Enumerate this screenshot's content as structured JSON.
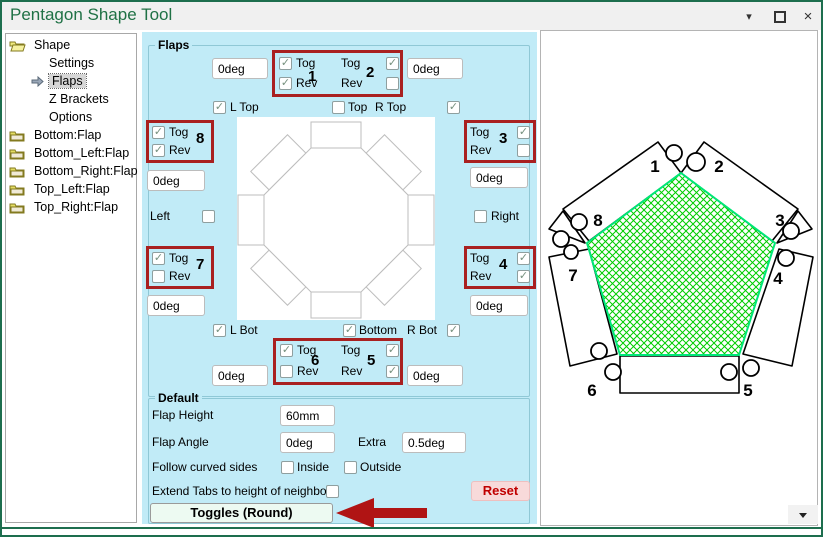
{
  "window": {
    "title": "Pentagon Shape Tool",
    "minimize_icon": "▾",
    "close_icon": "×"
  },
  "tree": {
    "items": [
      {
        "label": "Shape",
        "icon": "folder-open"
      },
      {
        "label": "Settings",
        "icon": "none"
      },
      {
        "label": "Flaps",
        "icon": "arrow",
        "selected": true
      },
      {
        "label": "Z Brackets",
        "icon": "none"
      },
      {
        "label": "Options",
        "icon": "none"
      },
      {
        "label": "Bottom:Flap",
        "icon": "folder"
      },
      {
        "label": "Bottom_Left:Flap",
        "icon": "folder"
      },
      {
        "label": "Bottom_Right:Flap",
        "icon": "folder"
      },
      {
        "label": "Top_Left:Flap",
        "icon": "folder"
      },
      {
        "label": "Top_Right:Flap",
        "icon": "folder"
      }
    ]
  },
  "labels": {
    "tog": "Tog",
    "rev": "Rev"
  },
  "flap_numbers": [
    "1",
    "2",
    "3",
    "4",
    "5",
    "6",
    "7",
    "8"
  ],
  "flaps": {
    "group_label": "Flaps",
    "side_labels": {
      "l_top": "L Top",
      "top": "Top",
      "r_top": "R Top",
      "left": "Left",
      "right": "Right",
      "l_bot": "L Bot",
      "bottom": "Bottom",
      "r_bot": "R Bot"
    }
  },
  "angles": {
    "f1": "0deg",
    "f2": "0deg",
    "f3": "0deg",
    "f4": "0deg",
    "f5": "0deg",
    "f6": "0deg",
    "f7": "0deg",
    "f8": "0deg"
  },
  "checks": {
    "f1_tog": "✓",
    "f1_rev": "✓",
    "f2_tog": "✓",
    "f2_rev": "",
    "f3_tog": "✓",
    "f3_rev": "",
    "f4_tog": "✓",
    "f4_rev": "✓",
    "f5_tog": "✓",
    "f5_rev": "✓",
    "f6_tog": "✓",
    "f6_rev": "",
    "f7_tog": "✓",
    "f7_rev": "",
    "f8_tog": "✓",
    "f8_rev": "✓",
    "l_top": "✓",
    "top": "",
    "r_top": "✓",
    "left": "",
    "right": "",
    "l_bot": "✓",
    "bottom": "✓",
    "r_bot": "✓",
    "inside": "",
    "outside": "",
    "extend": ""
  },
  "default_panel": {
    "group_label": "Default",
    "flap_height_label": "Flap Height",
    "flap_height_value": "60mm",
    "flap_angle_label": "Flap Angle",
    "flap_angle_value": "0deg",
    "extra_label": "Extra",
    "extra_value": "0.5deg",
    "follow_label": "Follow curved sides",
    "inside_label": "Inside",
    "outside_label": "Outside",
    "extend_label": "Extend Tabs to height of neighbour",
    "reset_label": "Reset",
    "toggles_label": "Toggles (Round)"
  },
  "colors": {
    "title_green": "#1f7145",
    "panel_cyan": "#c1ebf7",
    "highlight_red": "#a92020",
    "arrow_red": "#b01414",
    "pentagon_outline": "#00e878",
    "hatch_green": "#00cc00",
    "reset_pink": "#f8dada",
    "toggles_mint": "#edfaf2"
  }
}
